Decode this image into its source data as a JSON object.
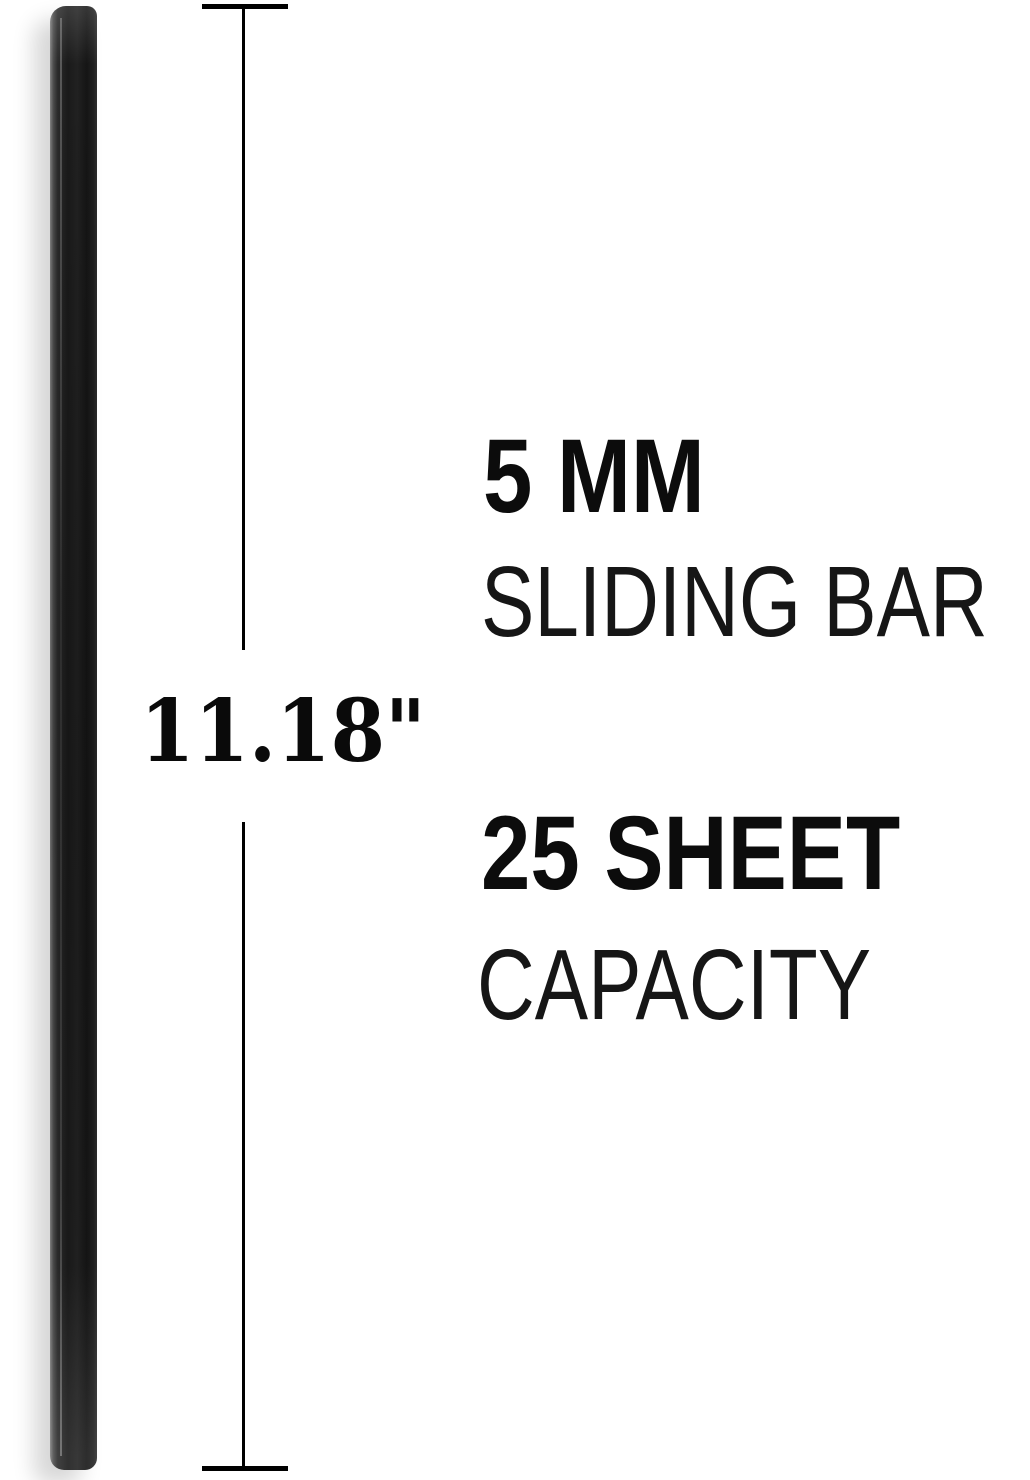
{
  "canvas": {
    "background": "#ffffff"
  },
  "product": {
    "kind": "sliding-bar",
    "body_color": "#1a1a1a",
    "edge_highlight_color": "#848484"
  },
  "dimension": {
    "length_label": "11.18\"",
    "line_color": "#000000"
  },
  "specs": [
    {
      "value": "5 MM",
      "label": "SLIDING BAR"
    },
    {
      "value": "25 SHEET",
      "label": "CAPACITY"
    }
  ]
}
